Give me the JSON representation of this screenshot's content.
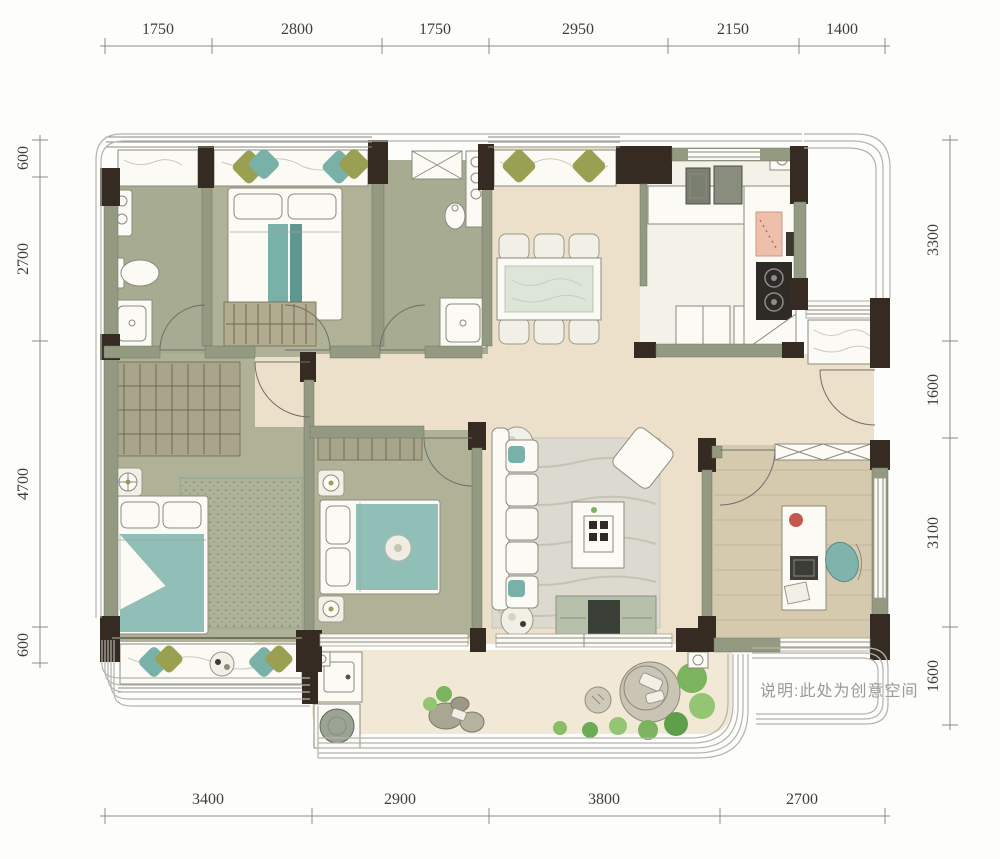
{
  "dimensions": {
    "top": [
      "1750",
      "2800",
      "1750",
      "2950",
      "2150",
      "1400"
    ],
    "bottom": [
      "3400",
      "2900",
      "3800",
      "2700"
    ],
    "left": [
      "600",
      "2700",
      "4700",
      "600"
    ],
    "right": [
      "3300",
      "1600",
      "3100",
      "1600"
    ]
  },
  "note": "说明:此处为创意空间",
  "colors": {
    "floor_common": "#ece0cb",
    "floor_bedroom": "#b0b297",
    "floor_bath": "#a6ab91",
    "floor_kitchen": "#f4f1e8",
    "floor_wood": "#d6caae",
    "floor_balcony": "#f1e8d5",
    "wall": "#949a82",
    "wall_dark": "#352b22",
    "accent_teal": "#79b1a8",
    "accent_teal_dark": "#5e9790",
    "accent_olive": "#9aa051",
    "seat_white": "#f8f6ef",
    "plant_green": "#7bb35e",
    "dim_text": "#3d3d3d",
    "note_text": "#9a9a98"
  }
}
